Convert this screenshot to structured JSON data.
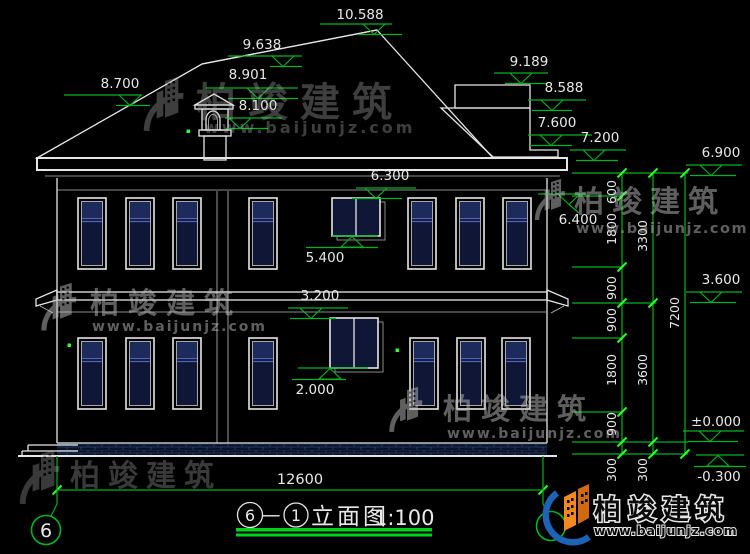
{
  "colors": {
    "bg": "#000000",
    "line": "#e6e6e6",
    "text": "#e9e9e9",
    "green": "#00b41e",
    "tick": "#2cff2c",
    "title_green": "#00d21e",
    "tile": "#8e8e8e",
    "glass": "#101736",
    "glass_light": "#1d2a5c",
    "transom": "#5066b4",
    "brick": "#27406e",
    "brick_bg": "#0b1228",
    "wm": "#bdbdbd",
    "logo_orange": "#f5891f",
    "logo_orange_dark": "#d06a10",
    "logo_blue": "#1e63b5"
  },
  "watermark": {
    "brand": "柏竣建筑",
    "url": "www.baijunjz.com"
  },
  "logo": {
    "brand": "柏竣建筑",
    "url": "www.baijunjz.com"
  },
  "levels": {
    "v10588": "10.588",
    "v9638": "9.638",
    "v8901": "8.901",
    "v8700": "8.700",
    "v8100": "8.100",
    "v9189": "9.189",
    "v8588": "8.588",
    "v7600": "7.600",
    "v7200": "7.200",
    "v6900": "6.900",
    "v6400": "6.400",
    "v6300": "6.300",
    "v5400": "5.400",
    "v3600": "3.600",
    "v3200": "3.200",
    "v2000": "2.000",
    "v0": "±0.000",
    "vm0300": "-0.300"
  },
  "dims": {
    "overall_width": "12600",
    "col1": [
      "600",
      "1800",
      "900",
      "900",
      "1800",
      "900",
      "300"
    ],
    "col2": [
      "3300",
      "3600",
      "300"
    ],
    "col3": [
      "7200"
    ]
  },
  "title": {
    "grid_bubble": "6",
    "axis_a": "6",
    "joiner": "—",
    "axis_b": "1",
    "name": "立面图",
    "scale": "1:100"
  }
}
